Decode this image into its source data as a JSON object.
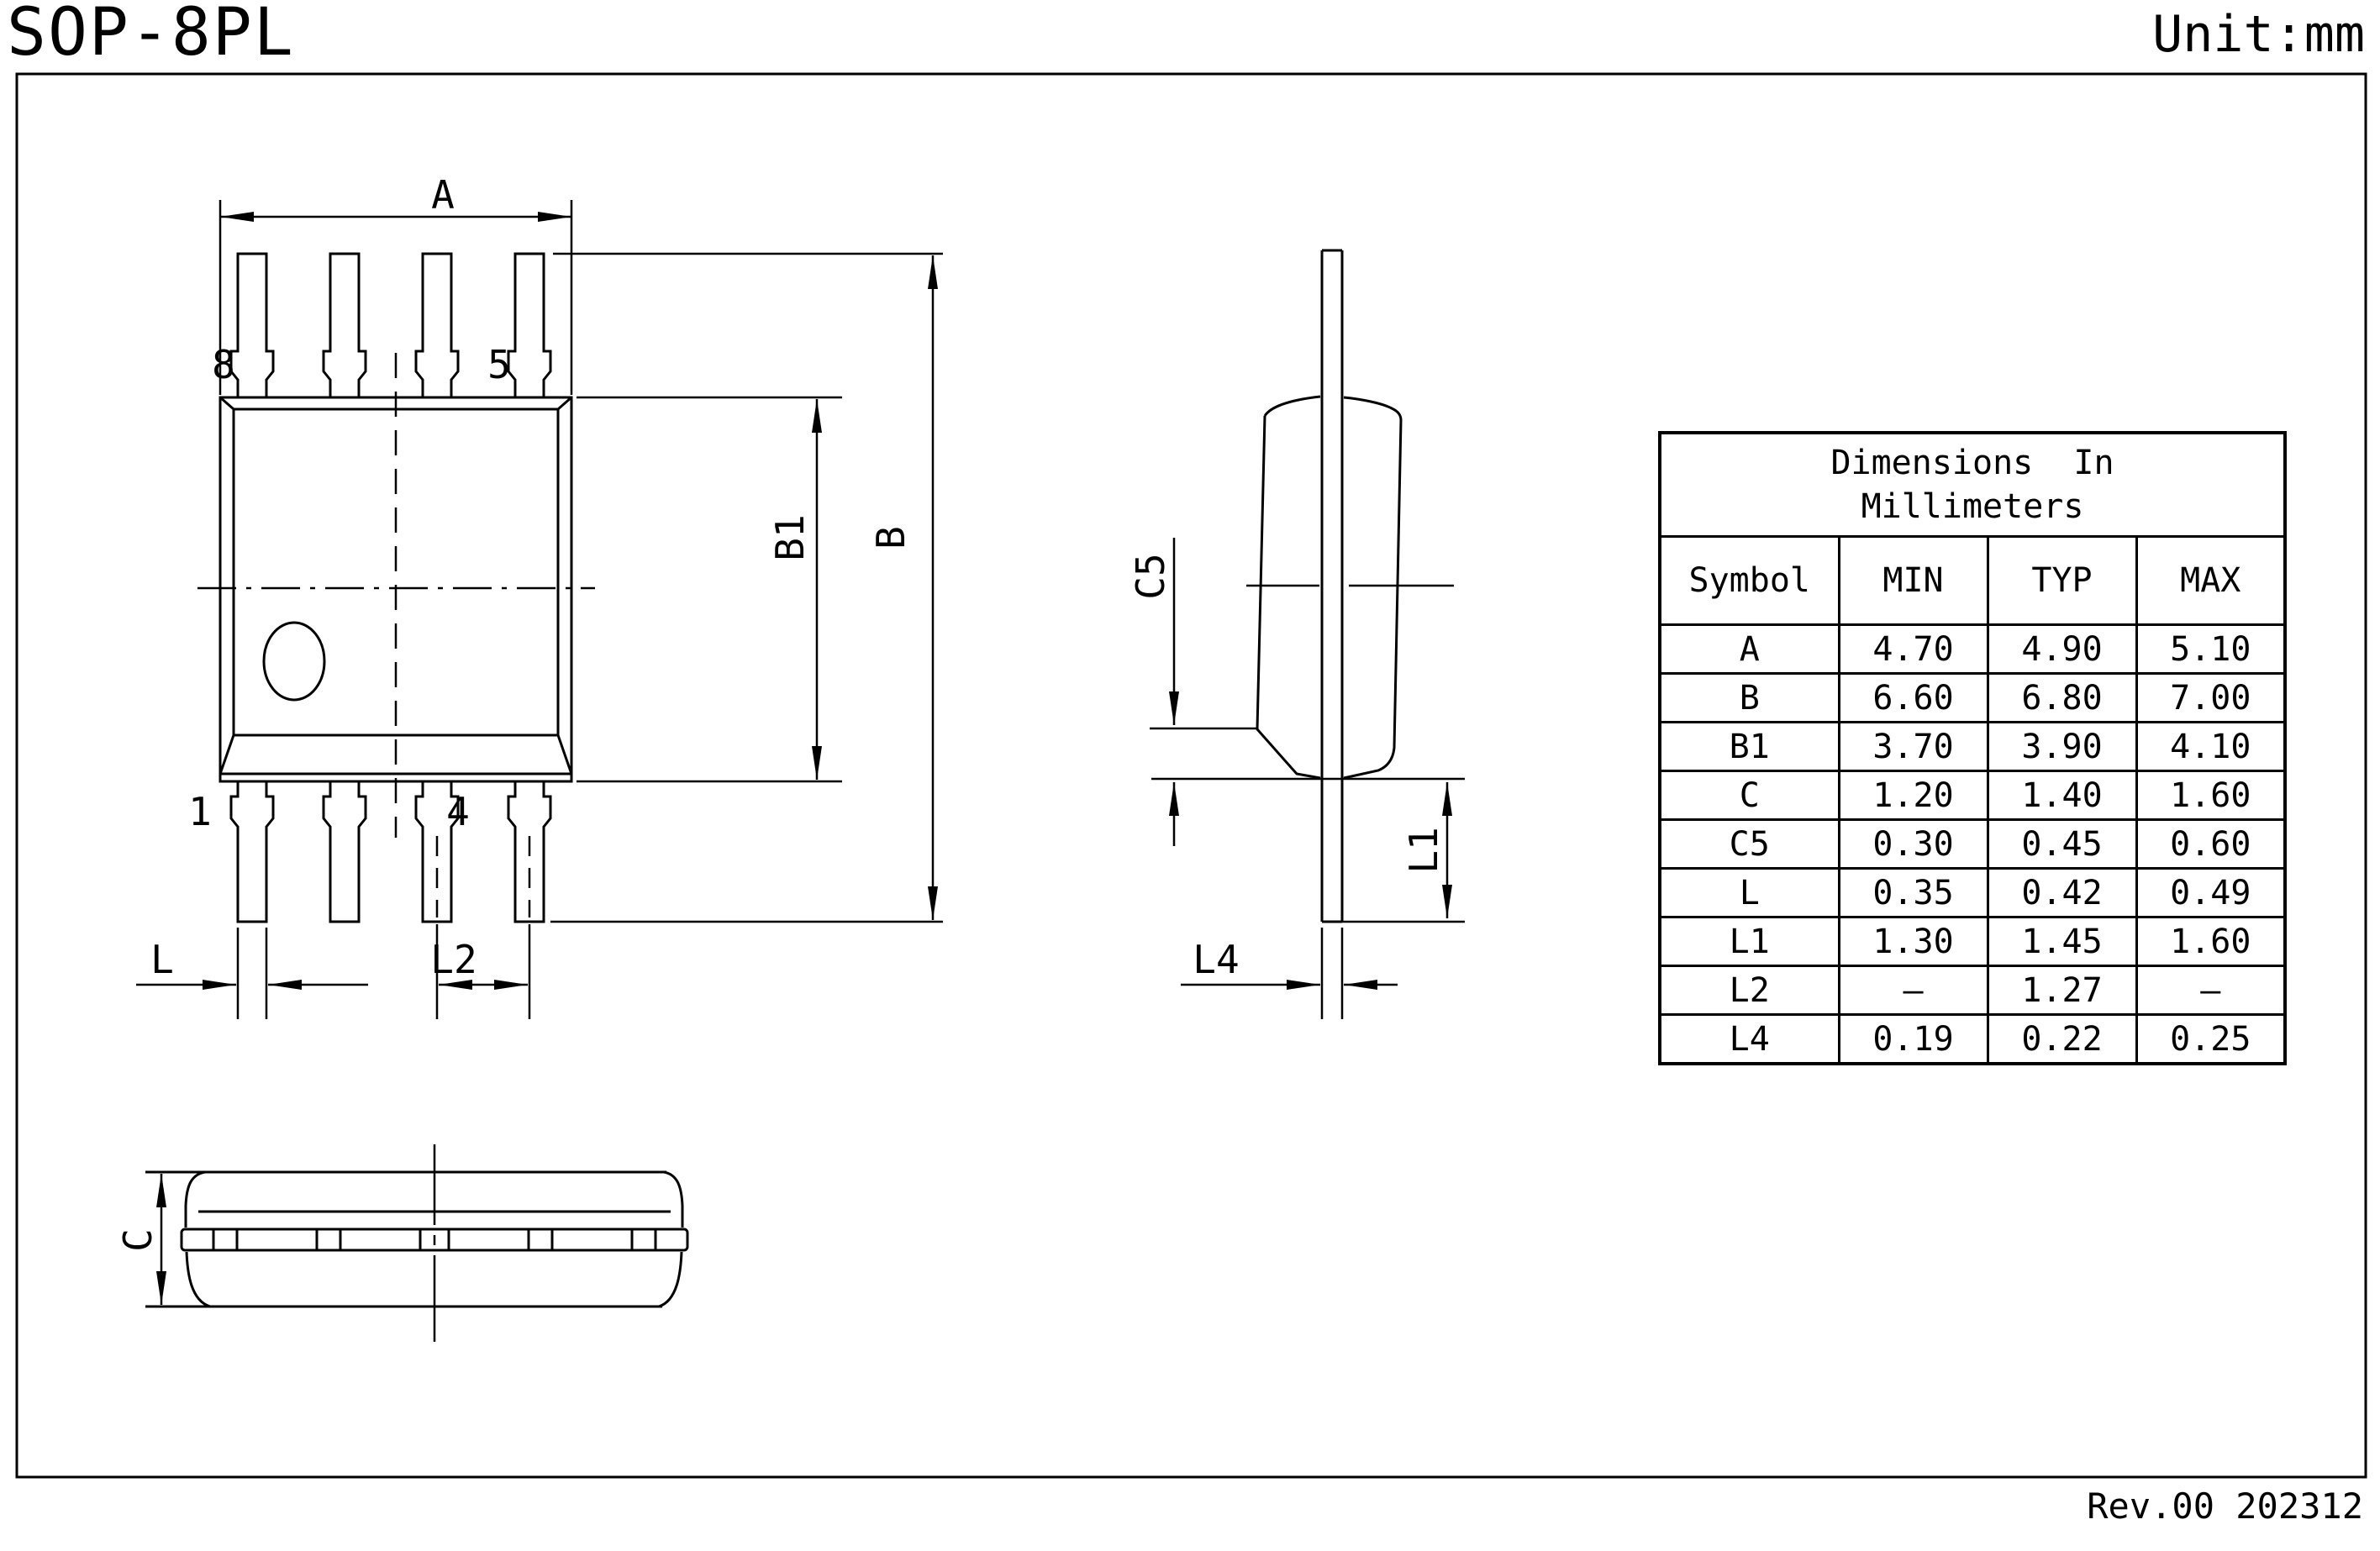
{
  "title": "SOP-8PL",
  "unit": "Unit:mm",
  "revision": "Rev.00 202312",
  "table": {
    "caption_line1": "Dimensions  In",
    "caption_line2": "Millimeters",
    "headers": [
      "Symbol",
      "MIN",
      "TYP",
      "MAX"
    ],
    "rows": [
      {
        "symbol": "A",
        "min": "4.70",
        "typ": "4.90",
        "max": "5.10"
      },
      {
        "symbol": "B",
        "min": "6.60",
        "typ": "6.80",
        "max": "7.00"
      },
      {
        "symbol": "B1",
        "min": "3.70",
        "typ": "3.90",
        "max": "4.10"
      },
      {
        "symbol": "C",
        "min": "1.20",
        "typ": "1.40",
        "max": "1.60"
      },
      {
        "symbol": "C5",
        "min": "0.30",
        "typ": "0.45",
        "max": "0.60"
      },
      {
        "symbol": "L",
        "min": "0.35",
        "typ": "0.42",
        "max": "0.49"
      },
      {
        "symbol": "L1",
        "min": "1.30",
        "typ": "1.45",
        "max": "1.60"
      },
      {
        "symbol": "L2",
        "min": "–",
        "typ": "1.27",
        "max": "–"
      },
      {
        "symbol": "L4",
        "min": "0.19",
        "typ": "0.22",
        "max": "0.25"
      }
    ]
  },
  "drawing": {
    "labels": {
      "dim_a": "A",
      "dim_b": "B",
      "dim_b1": "B1",
      "dim_c": "C",
      "dim_c5": "C5",
      "dim_l": "L",
      "dim_l1": "L1",
      "dim_l2": "L2",
      "dim_l4": "L4",
      "pin8": "8",
      "pin5": "5",
      "pin1": "1",
      "pin4": "4"
    },
    "line_color": "#000000",
    "background": "#ffffff"
  }
}
